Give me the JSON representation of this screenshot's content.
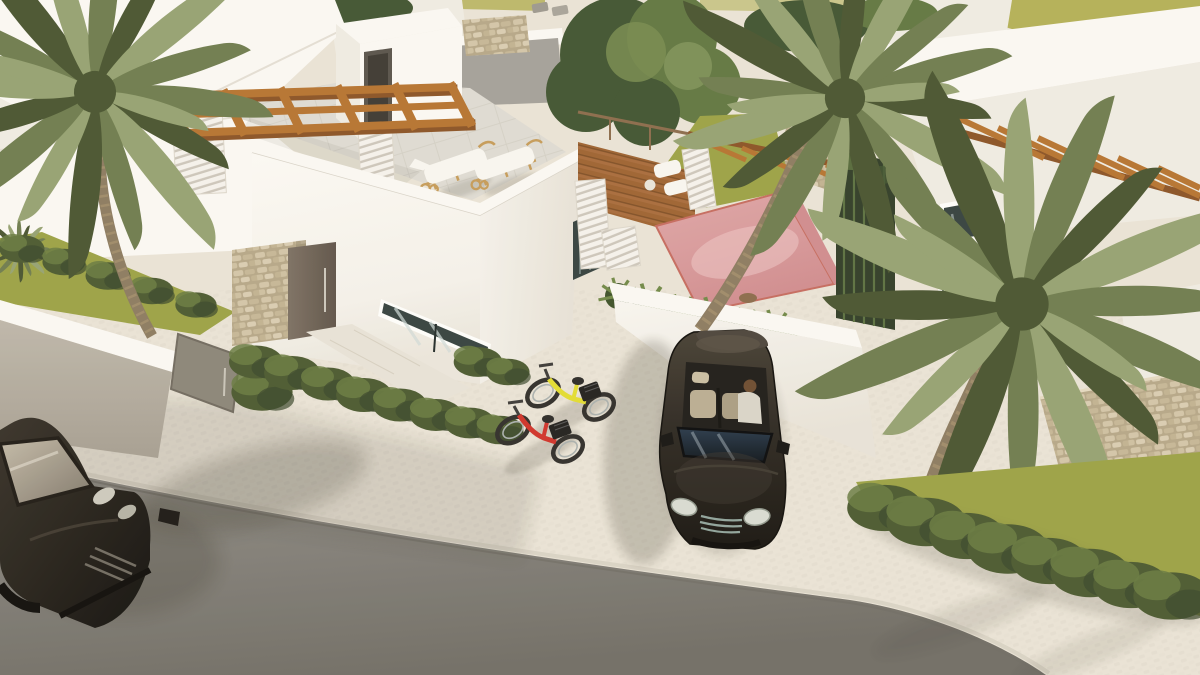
{
  "scene": {
    "type": "architectural-3d-render",
    "view": "aerial",
    "subject": "modern white villas with rooftop pergola terrace, plunge pool courtyard, palm trees, driveway with convertible car and two bicycles, asphalt street",
    "objects": [
      "white-villa-with-roof-terrace",
      "wooden-pergola-grid",
      "two-sun-loungers",
      "striped-privacy-pillars",
      "stone-clad-entrance-column",
      "entrance-door",
      "slit-window",
      "pink-plunge-pool-courtyard",
      "wooden-deck",
      "left-palm-tree",
      "center-palm-tree",
      "right-palm-tree",
      "leafy-tree",
      "black-convertible-car-with-driver",
      "dark-car-on-street",
      "yellow-city-bike",
      "red-city-bike",
      "garden-hedges",
      "gabion-stone-wall",
      "lawn-strips",
      "cobblestone-driveway",
      "sidewalk",
      "asphalt-street"
    ],
    "palette": {
      "field": "#b3af56",
      "white_wall": "#faf8f4",
      "white_wall_mid": "#efebe3",
      "white_wall_shade": "#ddd7cd",
      "wall_gray": "#b7b0a4",
      "wood": "#b5722f",
      "wood_dark": "#8a5224",
      "stone_base": "#b5a687",
      "stone_light": "#d9cdb4",
      "pool_pink": "#dfa6a8",
      "pool_pink_deep": "#cf8b8e",
      "pool_rim": "#c56a5e",
      "lawn": "#9aa144",
      "hedge": "#49582f",
      "hedge_light": "#66793f",
      "palm_dark": "#47532f",
      "palm_mid": "#6d7b4d",
      "palm_light": "#94a171",
      "trunk": "#8b7a5f",
      "trunk_light": "#a8946f",
      "foliage": "#3f5330",
      "foliage_light": "#5f7540",
      "pavement": "#e9e3d6",
      "asphalt": "#8f8c86",
      "asphalt_dark": "#6f6c65",
      "car_body": "#262119",
      "car_glass": "#1a232c",
      "car2_body": "#241f18",
      "bike_yellow": "#e2dc30",
      "bike_red": "#cf3129",
      "tire": "#2e2c29",
      "cushion": "#f8f6f1",
      "lounger_wood": "#c49a58",
      "door_brown": "#6e6156",
      "gate_gray": "#8a8478",
      "terrace_tile": "#dedbd3",
      "deck_wood": "#a76a3a",
      "glass_dark": "#33403e"
    }
  }
}
